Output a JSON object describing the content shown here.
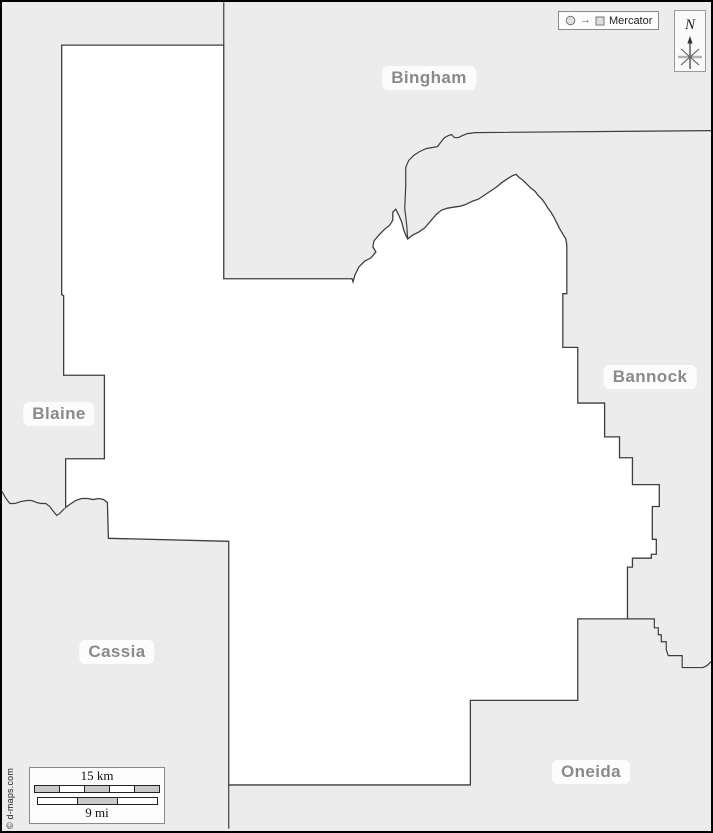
{
  "credit": "© d-maps.com",
  "legend": {
    "projection": "Mercator",
    "arrow_glyph": "→"
  },
  "compass": {
    "north": "N"
  },
  "scale": {
    "km": "15 km",
    "mi": "9 mi",
    "km_segments": [
      "#c9c9c9",
      "#ffffff",
      "#c9c9c9",
      "#ffffff",
      "#c9c9c9"
    ],
    "mi_segments": [
      "#ffffff",
      "#c9c9c9",
      "#ffffff"
    ]
  },
  "map": {
    "background": "#ececec",
    "region_fill": "#ffffff",
    "line_color": "#3e3e3e",
    "label_color": "#8a8a8a",
    "labels": [
      {
        "text": "Bingham",
        "x": 427,
        "y": 76
      },
      {
        "text": "Bannock",
        "x": 648,
        "y": 375
      },
      {
        "text": "Blaine",
        "x": 57,
        "y": 412
      },
      {
        "text": "Cassia",
        "x": 115,
        "y": 650
      },
      {
        "text": "Oneida",
        "x": 589,
        "y": 770
      }
    ],
    "shapes": {
      "highlighted_region": "60,43 223,43 223,278 352,278 353,281 355,274 359,266 365,260 371,257 376,251 373,246 374,240 379,234 385,228 390,224 393,219 393,211 396,208 399,214 402,221 404,229 406,234 408,238 413,234 419,231 425,227 431,220 437,213 442,209 448,207 454,206 461,205 467,203 473,200 479,198 485,194 491,190 497,186 503,181 509,177 514,174 517,173 520,176 524,179 528,183 532,187 536,190 539,194 543,198 546,202 549,207 552,211 555,216 558,222 561,228 564,233 567,238 568,244 568,293 564,293 564,347 579,347 579,403 606,403 606,437 621,437 621,458 634,458 634,485 661,485 661,507 654,507 654,540 658,540 658,555 653,555 653,559 634,559 634,568 629,568 629,620 579,620 579,702 471,702 471,787 228,787 228,542 107,539 106,503 102,500 97,499 92,500 86,499 80,499 74,501 68,505 64,508 64,459 103,459 103,375 62,375 62,295 60,294",
      "boundary_lines": [
        "223,0 223,43",
        "408,238 407,224 405,207 406,185 406,166 409,159 414,154 420,150 427,147 433,146 438,145 441,141 445,136 449,134 452,133 455,136 459,136 463,134 468,132 476,131 713,129",
        "63,509 58,514 55,516 51,511 48,507 44,504 39,504 35,503 30,501 25,501 19,502 13,504 8,504 4,499 0,492",
        "629,620 656,620 656,629 660,629 660,636 663,636 663,643 668,643 668,651 670,657 684,657 684,669 705,669 709,667 713,663",
        "228,787 228,831"
      ]
    }
  }
}
